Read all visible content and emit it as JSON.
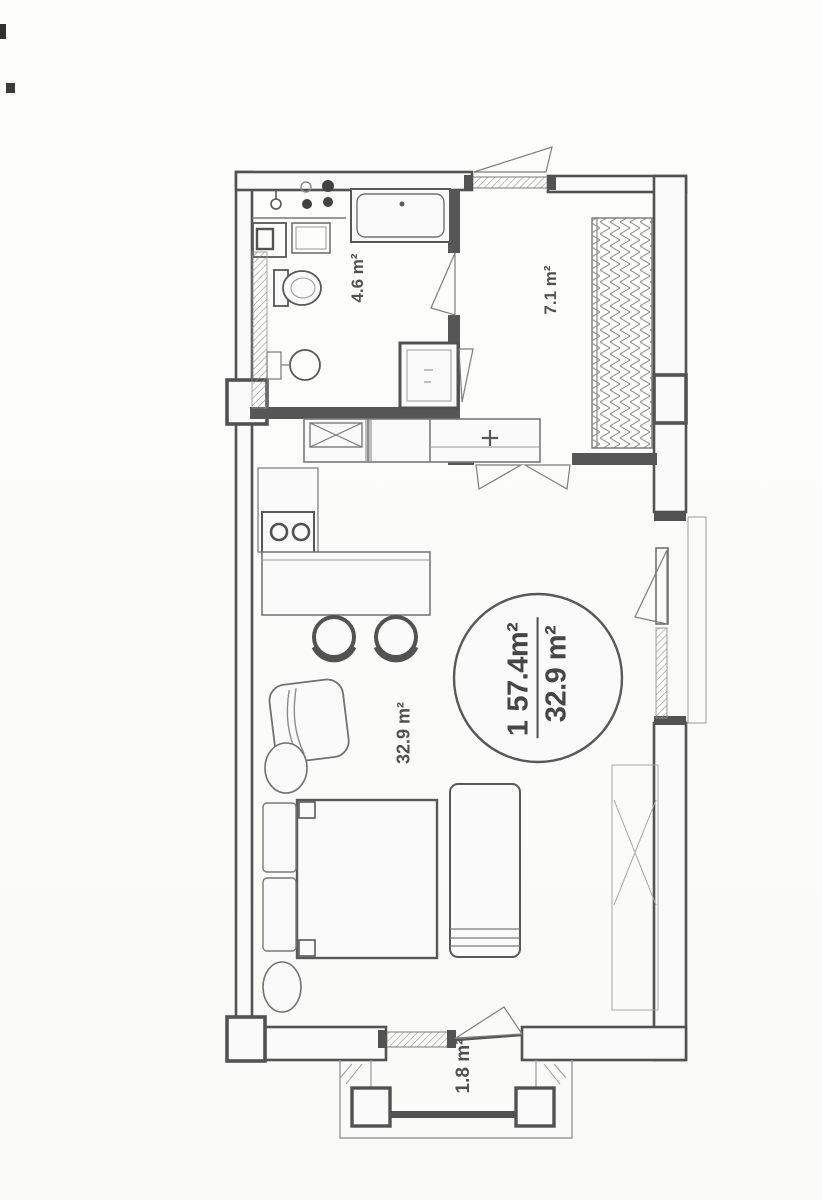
{
  "floor_plan": {
    "rooms": [
      {
        "name": "bathroom",
        "area_label": "4.6 m²"
      },
      {
        "name": "hall",
        "area_label": "7.1 m²"
      },
      {
        "name": "living-kitchen",
        "area_label": "32.9 m²"
      },
      {
        "name": "balcony",
        "area_label": "1.8 m²"
      }
    ],
    "area_stamp": {
      "unit_number": "1",
      "total_area": "57.4m²",
      "living_area": "32.9 m²"
    },
    "colors": {
      "wall": "#4e4e4e",
      "interior_wall": "#525252",
      "furniture_line": "#6f6f6f",
      "light_line": "#8f8f8f",
      "text": "#474747"
    }
  }
}
